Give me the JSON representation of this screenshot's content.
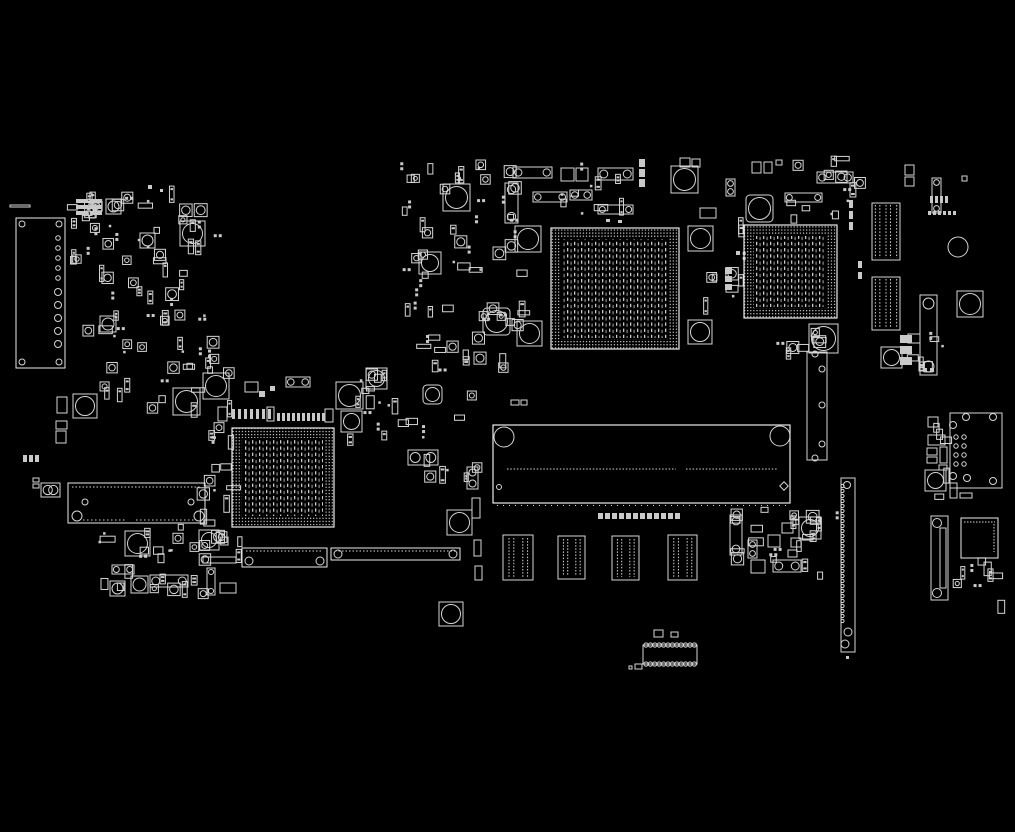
{
  "meta": {
    "description": "PCB boardview component-placement diagram, white outlines on black",
    "canvas": {
      "w": 1015,
      "h": 832
    },
    "colors": {
      "background": "#000000",
      "outline": "#d6d6d6",
      "bright": "#ececec",
      "dim": "#9e9e9e"
    }
  },
  "board": {
    "bgas": [
      {
        "name": "bga-chip-large",
        "x": 551,
        "y": 228,
        "w": 128,
        "h": 121
      },
      {
        "name": "bga-chip-right",
        "x": 744,
        "y": 225,
        "w": 93,
        "h": 93
      },
      {
        "name": "bga-chip-left",
        "x": 232,
        "y": 428,
        "w": 102,
        "h": 99
      }
    ],
    "slot": {
      "name": "board-to-board-slot",
      "x": 493,
      "y": 425,
      "w": 297,
      "h": 78,
      "holes": [
        [
          504,
          437,
          10
        ],
        [
          780,
          436,
          10
        ]
      ],
      "pinrow_y": 469,
      "pin_segments": [
        [
          507,
          676
        ],
        [
          686,
          777
        ]
      ],
      "small_circle": [
        499,
        487
      ],
      "diamond": [
        784,
        486
      ],
      "tick_y": 505.5,
      "tick_x": [
        497,
        788
      ]
    },
    "ffc_connectors": [
      {
        "name": "ffc-connector",
        "x": 503,
        "y": 535,
        "w": 30,
        "h": 45
      },
      {
        "name": "ffc-connector",
        "x": 558,
        "y": 536,
        "w": 27,
        "h": 43
      },
      {
        "name": "ffc-connector",
        "x": 612,
        "y": 536,
        "w": 27,
        "h": 44
      },
      {
        "name": "ffc-connector",
        "x": 668,
        "y": 535,
        "w": 29,
        "h": 45
      }
    ],
    "pin_header_blocks": [
      {
        "name": "pin-header-block",
        "x": 872,
        "y": 203,
        "w": 28,
        "h": 57
      },
      {
        "name": "pin-header-block",
        "x": 872,
        "y": 277,
        "w": 28,
        "h": 53
      }
    ],
    "left_tall_connector": {
      "name": "io-connector-left",
      "x": 16,
      "y": 218,
      "w": 49,
      "h": 150,
      "corner_circles": [
        [
          22,
          224
        ],
        [
          59,
          224
        ],
        [
          22,
          362
        ],
        [
          59,
          362
        ]
      ],
      "pin_circles_small": [
        [
          58,
          238
        ],
        [
          58,
          248
        ],
        [
          58,
          258
        ],
        [
          58,
          268
        ],
        [
          58,
          278
        ]
      ],
      "pin_circles_big": [
        [
          58,
          292
        ],
        [
          58,
          305
        ],
        [
          58,
          318
        ],
        [
          58,
          331
        ],
        [
          58,
          344
        ]
      ]
    },
    "left_long_connector": {
      "name": "battery-connector",
      "x": 68,
      "y": 483,
      "w": 137,
      "h": 40,
      "holes": [
        [
          77,
          516,
          5
        ],
        [
          199,
          516,
          5
        ]
      ],
      "posts": [
        [
          85,
          502
        ],
        [
          191,
          502
        ]
      ],
      "dot_top_x": [
        72,
        201
      ],
      "dot_bottom_segments": [
        [
          83,
          127
        ],
        [
          136,
          196
        ]
      ]
    },
    "right_edge_connector": {
      "name": "edge-connector-right",
      "x": 841,
      "y": 478,
      "w": 14,
      "h": 174,
      "holes": [
        [
          847,
          485,
          3.5
        ],
        [
          848,
          632,
          4
        ],
        [
          845,
          644,
          4
        ]
      ]
    },
    "vertical_slot_connector": {
      "name": "vertical-slot-connector",
      "x": 931,
      "y": 516,
      "w": 17,
      "h": 84,
      "holes": [
        [
          937,
          523,
          4.5
        ],
        [
          937,
          593,
          4.5
        ]
      ],
      "inner": [
        940,
        528,
        6,
        60
      ]
    },
    "qfn_chip": {
      "name": "qfn-chip",
      "x": 961,
      "y": 518,
      "w": 37,
      "h": 40
    },
    "corner_panel": {
      "name": "daughterboard-pad-panel",
      "x": 950,
      "y": 413,
      "w": 52,
      "h": 75,
      "corner_circles": [
        [
          966,
          417
        ],
        [
          993,
          417
        ],
        [
          953,
          425
        ],
        [
          953,
          476
        ],
        [
          993,
          481
        ],
        [
          967,
          478
        ]
      ],
      "pad_rows_y": [
        437,
        446,
        455,
        464
      ],
      "pad_cols_x": [
        956,
        964
      ]
    },
    "mid_tall_connector": {
      "name": "mid-tall-connector",
      "x": 807,
      "y": 352,
      "w": 20,
      "h": 108,
      "holes": [
        [
          815,
          354
        ],
        [
          822,
          369
        ],
        [
          822,
          405
        ],
        [
          822,
          444
        ],
        [
          815,
          458
        ]
      ]
    },
    "scallop_connector": {
      "name": "dip-socket-connector",
      "x": 643,
      "y": 645,
      "w": 54,
      "h": 19
    },
    "screw_pads": [
      [
        443,
        184,
        27,
        0
      ],
      [
        515,
        226,
        26,
        0
      ],
      [
        688,
        226,
        25,
        0
      ],
      [
        688,
        320,
        24,
        0
      ],
      [
        746,
        195,
        27,
        4
      ],
      [
        419,
        252,
        22,
        0
      ],
      [
        483,
        308,
        27,
        4
      ],
      [
        517,
        321,
        25,
        0
      ],
      [
        671,
        166,
        27,
        0
      ],
      [
        173,
        388,
        27,
        0
      ],
      [
        203,
        373,
        26,
        0
      ],
      [
        336,
        382,
        27,
        0
      ],
      [
        366,
        368,
        21,
        0
      ],
      [
        341,
        411,
        21,
        0
      ],
      [
        447,
        510,
        25,
        0
      ],
      [
        199,
        530,
        20,
        0
      ],
      [
        125,
        531,
        25,
        0
      ],
      [
        439,
        602,
        24,
        0
      ],
      [
        180,
        221,
        25,
        0
      ],
      [
        73,
        394,
        24,
        0
      ],
      [
        809,
        324,
        29,
        0
      ],
      [
        957,
        291,
        26,
        0
      ],
      [
        881,
        347,
        21,
        0
      ],
      [
        799,
        517,
        22,
        0
      ],
      [
        423,
        385,
        19,
        4
      ],
      [
        100,
        316,
        16,
        0
      ],
      [
        110,
        581,
        15,
        0
      ],
      [
        131,
        576,
        17,
        0
      ],
      [
        106,
        199,
        15,
        0
      ],
      [
        140,
        233,
        15,
        0
      ],
      [
        925,
        470,
        21,
        0
      ]
    ],
    "rings": [
      [
        958,
        247,
        10
      ]
    ],
    "h_connectors": [
      [
        513,
        167,
        39,
        11
      ],
      [
        533,
        192,
        34,
        10
      ],
      [
        570,
        190,
        22,
        10
      ],
      [
        598,
        168,
        35,
        12
      ],
      [
        598,
        205,
        35,
        9
      ],
      [
        817,
        172,
        36,
        11
      ],
      [
        785,
        193,
        37,
        9
      ],
      [
        408,
        450,
        30,
        15
      ],
      [
        150,
        575,
        38,
        12
      ],
      [
        112,
        565,
        22,
        9
      ],
      [
        286,
        377,
        24,
        10
      ],
      [
        773,
        560,
        28,
        12
      ],
      [
        41,
        483,
        19,
        14
      ]
    ],
    "bottom_connectors": [
      [
        242,
        548,
        85,
        19
      ],
      [
        331,
        548,
        129,
        12
      ]
    ],
    "v_connectors": [
      [
        505,
        183,
        13,
        40
      ],
      [
        920,
        295,
        17,
        80
      ],
      [
        932,
        178,
        9,
        35
      ],
      [
        726,
        179,
        9,
        17
      ],
      [
        730,
        515,
        12,
        40
      ],
      [
        748,
        540,
        9,
        18
      ],
      [
        207,
        568,
        8,
        27
      ],
      [
        467,
        467,
        11,
        22
      ]
    ],
    "rects": [
      [
        57,
        397,
        10,
        16
      ],
      [
        56,
        421,
        11,
        8
      ],
      [
        56,
        431,
        10,
        12
      ],
      [
        33,
        478,
        6,
        4
      ],
      [
        33,
        484,
        6,
        4
      ],
      [
        905,
        165,
        9,
        10
      ],
      [
        905,
        177,
        9,
        9
      ],
      [
        962,
        176,
        5,
        5
      ],
      [
        752,
        162,
        9,
        11
      ],
      [
        764,
        162,
        8,
        11
      ],
      [
        776,
        160,
        6,
        5
      ],
      [
        680,
        158,
        10,
        9
      ],
      [
        692,
        159,
        8,
        8
      ],
      [
        561,
        168,
        13,
        13
      ],
      [
        576,
        168,
        12,
        13
      ],
      [
        220,
        583,
        16,
        10
      ],
      [
        203,
        557,
        33,
        6
      ],
      [
        700,
        208,
        16,
        10
      ],
      [
        511,
        400,
        8,
        5
      ],
      [
        521,
        400,
        6,
        5
      ],
      [
        472,
        498,
        8,
        20
      ],
      [
        474,
        540,
        7,
        16
      ],
      [
        475,
        566,
        7,
        14
      ],
      [
        654,
        630,
        9,
        7
      ],
      [
        671,
        632,
        7,
        5
      ],
      [
        635,
        664,
        7,
        5
      ],
      [
        629,
        666,
        3,
        3
      ],
      [
        245,
        382,
        13,
        10
      ],
      [
        218,
        407,
        9,
        14
      ],
      [
        267,
        407,
        7,
        14
      ],
      [
        325,
        409,
        8,
        13
      ],
      [
        928,
        417,
        10,
        10
      ],
      [
        928,
        435,
        17,
        10
      ],
      [
        927,
        448,
        10,
        7
      ],
      [
        927,
        457,
        10,
        6
      ],
      [
        940,
        447,
        7,
        16
      ],
      [
        939,
        465,
        8,
        5
      ],
      [
        950,
        483,
        7,
        15
      ],
      [
        960,
        493,
        12,
        5
      ],
      [
        768,
        535,
        12,
        12
      ],
      [
        782,
        523,
        11,
        10
      ],
      [
        791,
        538,
        10,
        9
      ],
      [
        788,
        550,
        9,
        7
      ],
      [
        751,
        560,
        14,
        13
      ],
      [
        908,
        334,
        12,
        9
      ],
      [
        10,
        205,
        20,
        2
      ]
    ],
    "dots": [
      [
        606,
        219,
        4,
        3
      ],
      [
        618,
        220,
        4,
        3
      ],
      [
        259,
        391,
        6,
        6
      ],
      [
        270,
        386,
        5,
        5
      ],
      [
        148,
        185,
        4,
        4
      ],
      [
        160,
        189,
        3,
        3
      ],
      [
        846,
        656,
        3,
        3
      ],
      [
        923,
        368,
        4,
        4
      ],
      [
        930,
        368,
        4,
        4
      ],
      [
        736,
        251,
        4,
        4
      ]
    ],
    "dash_rows": [
      [
        232,
        409,
        7,
        6,
        3,
        10
      ],
      [
        277,
        413,
        10,
        5,
        3,
        8
      ],
      [
        928,
        211,
        6,
        5,
        3,
        4
      ],
      [
        930,
        196,
        4,
        5,
        3,
        7
      ],
      [
        598,
        513,
        12,
        7,
        5,
        6
      ],
      [
        23,
        455,
        3,
        6,
        4,
        7
      ]
    ],
    "dash_cols": [
      [
        76,
        199,
        3,
        6,
        12,
        4
      ],
      [
        90,
        199,
        3,
        6,
        12,
        4
      ],
      [
        849,
        200,
        3,
        11,
        4,
        8
      ],
      [
        858,
        261,
        2,
        11,
        4,
        7
      ],
      [
        639,
        159,
        3,
        10,
        6,
        8
      ],
      [
        725,
        268,
        3,
        8,
        7,
        6
      ],
      [
        900,
        335,
        3,
        11,
        12,
        8
      ]
    ],
    "clusters": [
      [
        66,
        186,
        150,
        146,
        60,
        7
      ],
      [
        96,
        334,
        130,
        70,
        26,
        11
      ],
      [
        96,
        524,
        142,
        72,
        30,
        13
      ],
      [
        398,
        156,
        122,
        210,
        64,
        17
      ],
      [
        338,
        368,
        140,
        120,
        28,
        19
      ],
      [
        196,
        396,
        34,
        126,
        15,
        23
      ],
      [
        556,
        158,
        86,
        56,
        10,
        29
      ],
      [
        696,
        206,
        48,
        128,
        10,
        31
      ],
      [
        762,
        326,
        56,
        22,
        7,
        37
      ],
      [
        780,
        156,
        78,
        60,
        14,
        41
      ],
      [
        898,
        330,
        48,
        46,
        7,
        43
      ],
      [
        924,
        414,
        22,
        90,
        5,
        47
      ],
      [
        730,
        506,
        106,
        68,
        22,
        53
      ],
      [
        952,
        556,
        56,
        50,
        9,
        59
      ]
    ]
  }
}
